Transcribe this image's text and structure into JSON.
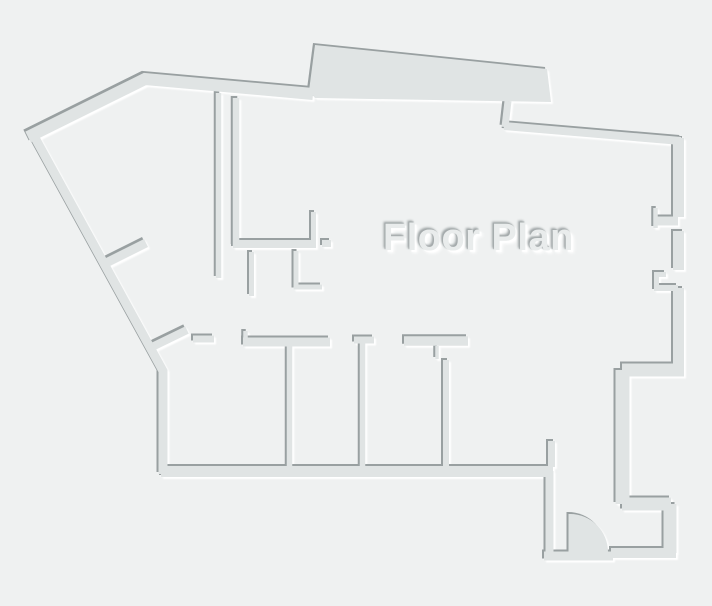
{
  "canvas": {
    "width": 712,
    "height": 606,
    "background": "#eff1f1"
  },
  "title": {
    "text": "Floor Plan",
    "color": "#e9ecec",
    "shadow_dark": "#a5abac",
    "shadow_light": "#ffffff"
  },
  "style": {
    "wall_fill": "#e0e4e4",
    "edge_dark": "#99a0a1",
    "edge_light": "#ffffff"
  },
  "walls": [
    {
      "name": "outer-top-left-wall",
      "d": "M28,137 L145,79 L313,94",
      "w": 12
    },
    {
      "name": "outer-left-diagonal-wall",
      "d": "M34,136 L163,371 L163,474",
      "w": 9
    },
    {
      "name": "top-bump",
      "d": "M309,91 L315,45 L547,69 L551,102 L315,98 Z",
      "filled": true
    },
    {
      "name": "top-wall-jamb",
      "d": "M508,101 L505,127",
      "w": 7
    },
    {
      "name": "outer-top-right-wall",
      "d": "M504,126 L681,141",
      "w": 8
    },
    {
      "name": "right-wall-upper",
      "d": "M678.5,138 L678.5,217",
      "w": 11
    },
    {
      "name": "right-notch1-stub",
      "d": "M678,221 L656,221",
      "w": 9
    },
    {
      "name": "right-notch1-tick",
      "d": "M655.5,208 L655.5,228",
      "w": 4.5
    },
    {
      "name": "right-wall-middle",
      "d": "M678.5,231 L678.5,270",
      "w": 11
    },
    {
      "name": "right-notch2-bracket",
      "d": "M666,274.5 L656.5,274.5 L656.5,285",
      "w": 5
    },
    {
      "name": "right-notch2-sill",
      "d": "M654,288 L678,288",
      "w": 6
    },
    {
      "name": "right-wall-lower",
      "d": "M678.5,288 L678.5,366",
      "w": 11
    },
    {
      "name": "right-jog-top",
      "d": "M684,370 L622,370",
      "w": 13
    },
    {
      "name": "right-jog-side",
      "d": "M622.5,370 L622.5,504",
      "w": 14
    },
    {
      "name": "right-jog-bottom",
      "d": "M622,504 L671,504",
      "w": 13
    },
    {
      "name": "entry-right-wall",
      "d": "M670,504 L670,553",
      "w": 13
    },
    {
      "name": "entry-bottom-wall",
      "d": "M676,553 L611,553",
      "w": 10
    },
    {
      "name": "entry-threshold",
      "d": "M544,556 L613,556",
      "w": 9
    },
    {
      "name": "entry-left-wall",
      "d": "M549.5,557 L549.5,471",
      "w": 8
    },
    {
      "name": "rooms-bottom-wall",
      "d": "M161,471.5 L553,471.5",
      "w": 11
    },
    {
      "name": "rooms-bottom-stub",
      "d": "M551.5,467 L551.5,441",
      "w": 7
    },
    {
      "name": "rooms-top-wall-left",
      "d": "M243,342 L330,342",
      "w": 9
    },
    {
      "name": "rooms-top-wall-tick",
      "d": "M245.5,331 L245.5,342",
      "w": 4.5
    },
    {
      "name": "rooms-top-dash",
      "d": "M193,339 L214,339",
      "w": 7
    },
    {
      "name": "room-divider-1",
      "d": "M289.5,346 L289.5,467",
      "w": 5.5
    },
    {
      "name": "room-divider-2-cap",
      "d": "M354,340 L374,340",
      "w": 7
    },
    {
      "name": "room-divider-2",
      "d": "M362.5,343 L362.5,467",
      "w": 5.5
    },
    {
      "name": "room-divider-3-bar",
      "d": "M404,341 L468,341",
      "w": 9.5
    },
    {
      "name": "room-divider-3-tick",
      "d": "M437,346 L437,359",
      "w": 3.5
    },
    {
      "name": "room-divider-3",
      "d": "M446,360 L446,467",
      "w": 6
    },
    {
      "name": "interior-vertical-long",
      "d": "M218.5,93 L218.5,278",
      "w": 5.5
    },
    {
      "name": "interior-vertical-short",
      "d": "M236,98 L236,246",
      "w": 6.5
    },
    {
      "name": "interior-horizontal-wall",
      "d": "M233,244 L316,244",
      "w": 8
    },
    {
      "name": "interior-stub-up",
      "d": "M313.5,244 L313.5,212",
      "w": 5
    },
    {
      "name": "interior-mini-segment",
      "d": "M322,243.5 L331,243.5",
      "w": 7
    },
    {
      "name": "interior-stub-a",
      "d": "M251.5,252 L251.5,296",
      "w": 5
    },
    {
      "name": "interior-stub-b",
      "d": "M296,251 L296,287 L322,287",
      "w": 5
    },
    {
      "name": "diagonal-wall-stub-1",
      "d": "M106,263 L146,243",
      "w": 9
    },
    {
      "name": "diagonal-wall-stub-2",
      "d": "M154,346 L187,330",
      "w": 8
    },
    {
      "name": "door-swing",
      "d": "M570,514 A38,38 0 0 1 608,552 L570,552 Z",
      "filled": true
    },
    {
      "name": "door-leaf",
      "d": "M570,514 L570,552",
      "w": 3
    }
  ]
}
